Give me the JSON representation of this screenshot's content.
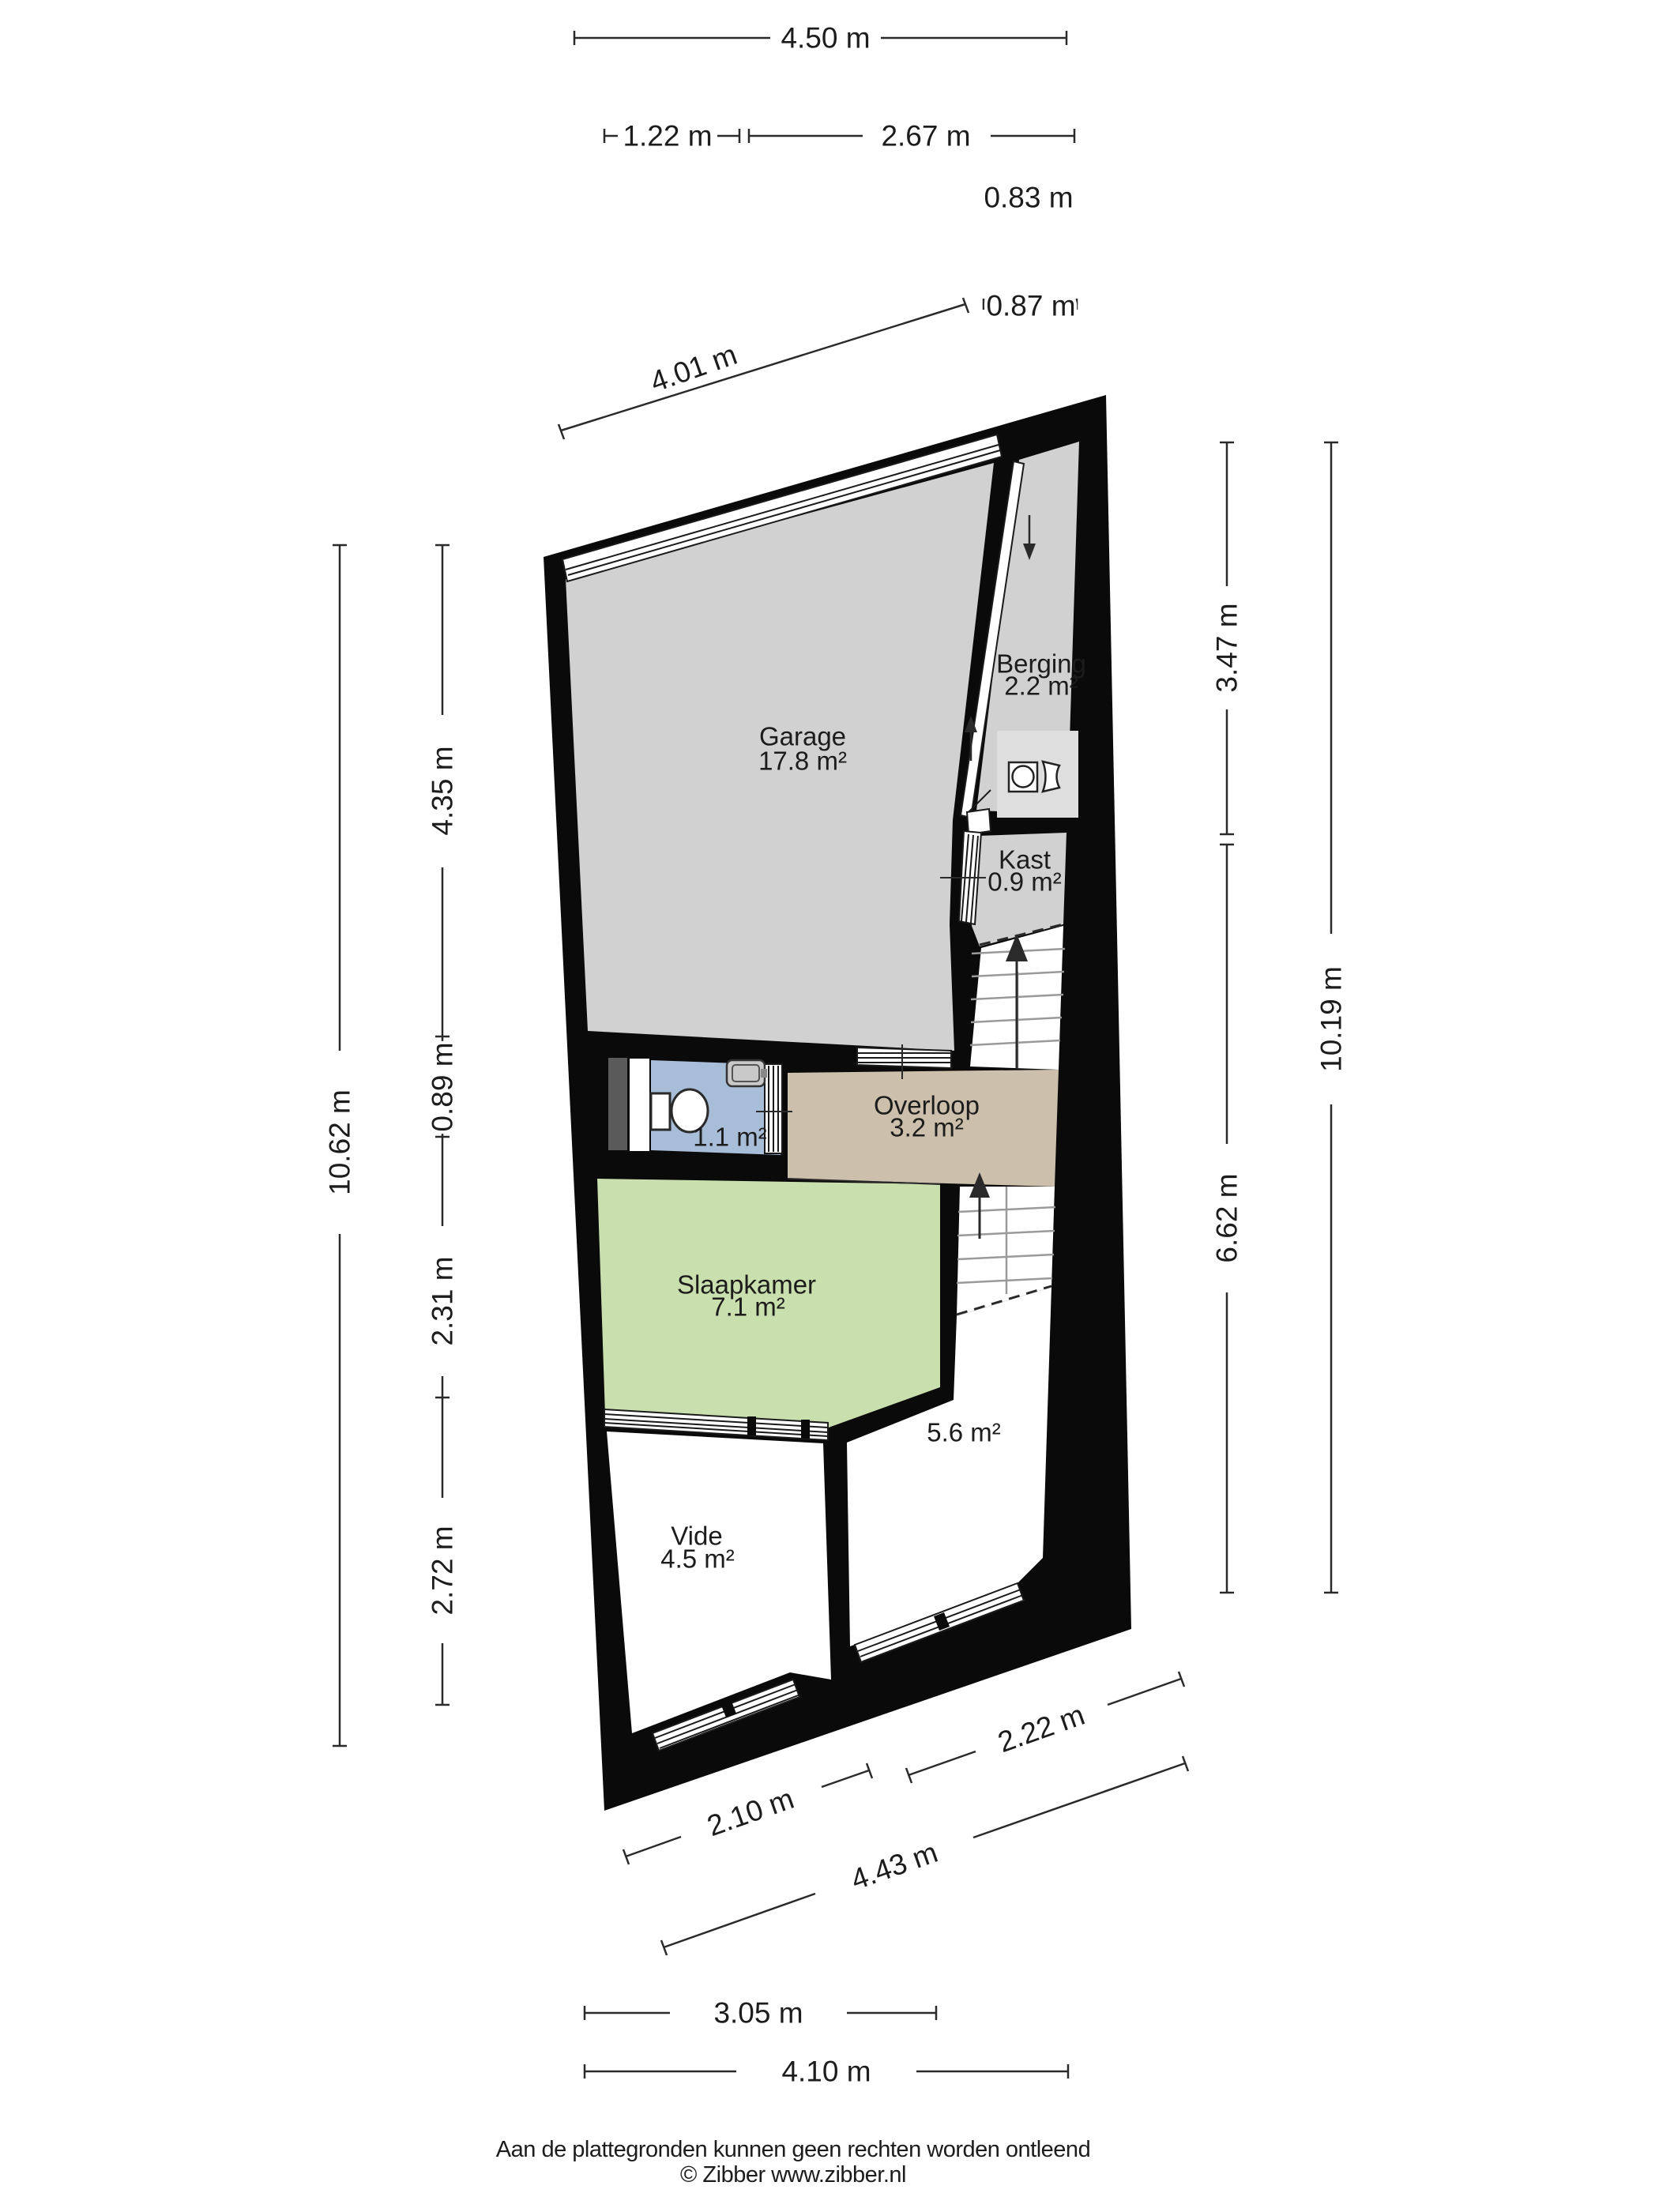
{
  "colors": {
    "wall": "#0a0a0a",
    "floor_gray": "#d1d1d1",
    "floor_tan": "#ccbfab",
    "floor_green": "#c9dfad",
    "floor_blue": "#a8bdd8",
    "floor_white": "#ffffff",
    "appliance_mat": "#dedede",
    "door_recess": "#5a5a5a",
    "sink": "#c9c9c9"
  },
  "rooms": {
    "garage": {
      "name": "Garage",
      "area": "17.8 m²"
    },
    "berging": {
      "name": "Berging",
      "area": "2.2 m²"
    },
    "kast": {
      "name": "Kast",
      "area": "0.9 m²"
    },
    "overloop": {
      "name": "Overloop",
      "area": "3.2 m²"
    },
    "toilet": {
      "area": "1.1 m²"
    },
    "slaapkamer": {
      "name": "Slaapkamer",
      "area": "7.1 m²"
    },
    "vide": {
      "name": "Vide",
      "area": "4.5 m²"
    },
    "zolderkamer": {
      "area": "5.6 m²"
    }
  },
  "dimensions": {
    "top_total": "4.50 m",
    "top_seg1": "1.22 m",
    "top_seg2": "2.67 m",
    "top_offset1": "0.83 m",
    "top_offset2": "0.87 m",
    "top_wall": "4.01 m",
    "left_total": "10.62 m",
    "left_seg1": "4.35 m",
    "left_seg2": "0.89 m",
    "left_seg3": "2.31 m",
    "left_seg4": "2.72 m",
    "right_seg1": "3.47 m",
    "right_total": "10.19 m",
    "right_seg2": "6.62 m",
    "bottom_seg1": "2.10 m",
    "bottom_seg2": "2.22 m",
    "bottom_wall": "4.43 m",
    "bottom_inner": "3.05 m",
    "bottom_total": "4.10 m"
  },
  "icons": {
    "washing_machine": "washing-machine-icon",
    "laundry_basket": "laundry-basket-icon",
    "toilet": "toilet-icon",
    "sink": "sink-icon",
    "stairs_up": "arrow-up-icon",
    "stairs_down": "arrow-down-icon"
  },
  "footer": {
    "line1": "Aan de plattegronden kunnen geen rechten worden ontleend",
    "line2": "© Zibber www.zibber.nl"
  }
}
